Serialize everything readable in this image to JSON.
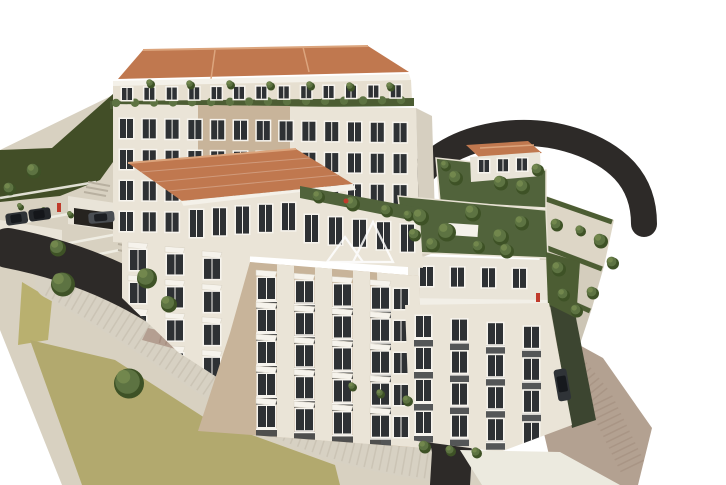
{
  "image": {
    "alt": "Aerial 3D architectural rendering of a hillside apartment complex with terracotta roofs, rooftop gardens, curving asphalt access roads, parked cars, stepped retaining terraces and a grassy slope",
    "background": "#ffffff"
  },
  "colors": {
    "background": "#ffffff",
    "hill_green": "#424e27",
    "terrain_beige": "#d8d1c1",
    "khaki_ground": "#b2a96e",
    "khaki_patch": "#b9b06f",
    "gravel_light": "#d7d1c3",
    "gravel_speckle": "#bfb8a8",
    "road_asphalt": "#2d2a28",
    "garage_dark": "#26231f",
    "brick_paving": "#b29c8e",
    "path_brown": "#b3a191",
    "roof_terracotta": "#c0784f",
    "roof_ridge": "#dba47c",
    "facade_cream": "#eae4d7",
    "facade_cream_dark": "#e6dfd0",
    "facade_tan": "#c8b49a",
    "facade_side_shade": "#d6cfc0",
    "eave_white": "#f4f1e9",
    "window_glass": "#2e3134",
    "window_frame": "#f7f4ee",
    "awning_white": "#f6f3ec",
    "railing_dark": "#3a3d41",
    "hedge_green": "#4c5d33",
    "garden_green": "#51633b",
    "tree_green": "#5d7342",
    "tree_dark": "#3e5226",
    "tree_light": "#74894f",
    "parapet_white": "#f2efe7",
    "wall_white": "#e9e4d8",
    "stepped_wall": "#ddd6c6",
    "dark_hedge_wall": "#3c4530",
    "car_dark": "#2f3337",
    "car_grey": "#4a4e53",
    "accent_red": "#c03a2b",
    "watermark": "#ffffff"
  },
  "watermark": {
    "label": "twin-triangle-logo",
    "opacity": 0.85
  }
}
